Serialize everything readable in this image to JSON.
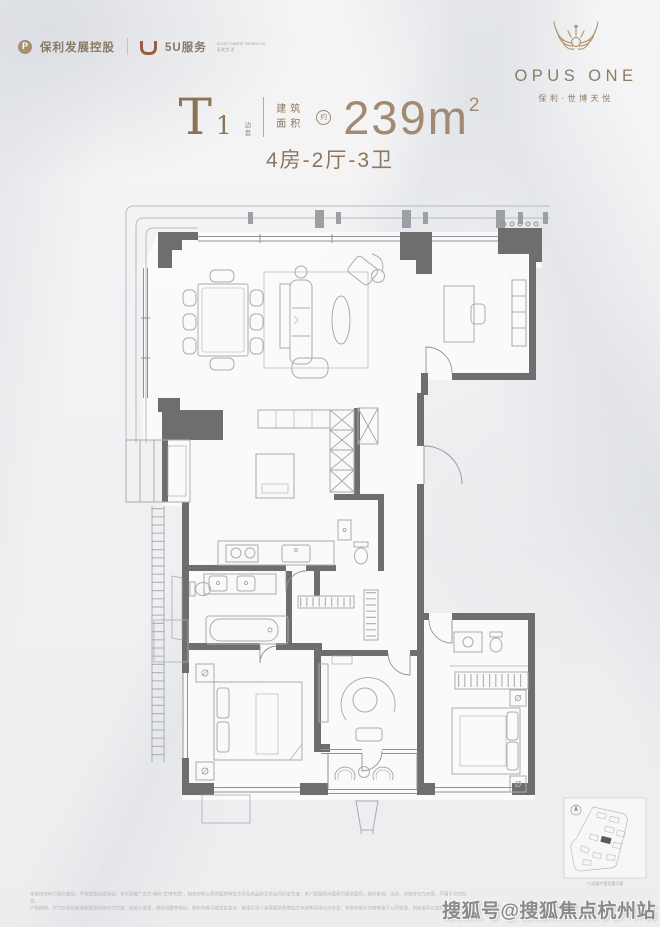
{
  "page": {
    "width": 660,
    "height": 927
  },
  "colors": {
    "brand_brown": "#8c7660",
    "brand_gold": "#b29367",
    "area_value_color": "#a08a72",
    "wall_gray": "#6e6e6e",
    "furniture_line": "#a7adb2",
    "window_line": "#8d9499",
    "background": "#f1f2f3",
    "watermark_gray": "#8a8a8a"
  },
  "header": {
    "logo_poly_text": "保利发展控股",
    "logo_5u_text": "5U服务",
    "logo_5u_tagline_1": "CUSTOMER SERVICE",
    "logo_5u_tagline_2": "无忧生活",
    "brand_name": "OPUS ONE",
    "brand_subtitle": "保利·世博天悦"
  },
  "title_block": {
    "unit_letter": "T",
    "unit_number": "1",
    "unit_tag_char1": "边",
    "unit_tag_char2": "套",
    "area_label_line1": "建筑",
    "area_label_line2": "面积",
    "approx_mark": "约",
    "area_value": "239m",
    "area_exponent": "2",
    "layout_text": "4房-2厅-3卫"
  },
  "floorplan": {
    "type": "apartment-floor-plan",
    "rooms": [
      "客厅/餐厅",
      "书房",
      "厨房",
      "主卧",
      "卧室",
      "卧室",
      "家庭室",
      "卫生间x3",
      "阳台",
      "设备平台"
    ],
    "bedrooms": 4,
    "living_rooms": 2,
    "bathrooms": 3
  },
  "footer": {
    "disclaimer_line1": "本宣传资料为要约邀请，不构成要约或承诺；本项目推广名为“保利·世博天悦”，相关权利以政府最终审批文件及商品房买卖合同约定为准；本户型图所示面积为建筑面积，图中家具、洁具、绿植等仅为示意，不属于交付标准，",
    "disclaimer_line2": "户型结构、尺寸以规划核准图纸及实际交付为准；因设计变更、规划调整等原因，图示内容可能发生变化，敬请买受人留意最新政府批文与销售现场公示信息；本资料部分内容来源于公开渠道，如有差异以实际为准。",
    "keyplan_caption": "T1边套户型位置示意",
    "watermark": "搜狐号@搜狐焦点杭州站"
  }
}
